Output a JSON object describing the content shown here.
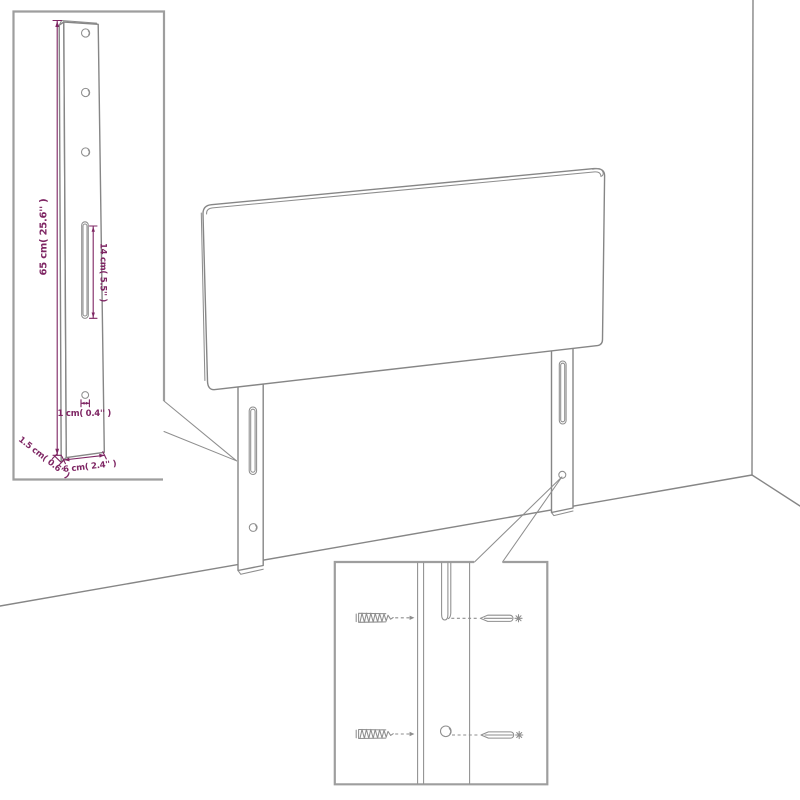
{
  "diagram_type": "headboard-assembly-drawing",
  "colors": {
    "background": "#ffffff",
    "outline": "#868686",
    "inset_border": "#9e9e9e",
    "dimension": "#7e2563"
  },
  "dimensions": {
    "height": {
      "label": "65 cm( 25.6'' )"
    },
    "slot_length": {
      "label": "14 cm( 5.5'' )"
    },
    "hole_diameter": {
      "label": "1 cm( 0.4'' )"
    },
    "leg_thickness": {
      "label": "1.5 cm( 0.6'' )"
    },
    "leg_width": {
      "label": "6 cm( 2.4'' )"
    }
  }
}
